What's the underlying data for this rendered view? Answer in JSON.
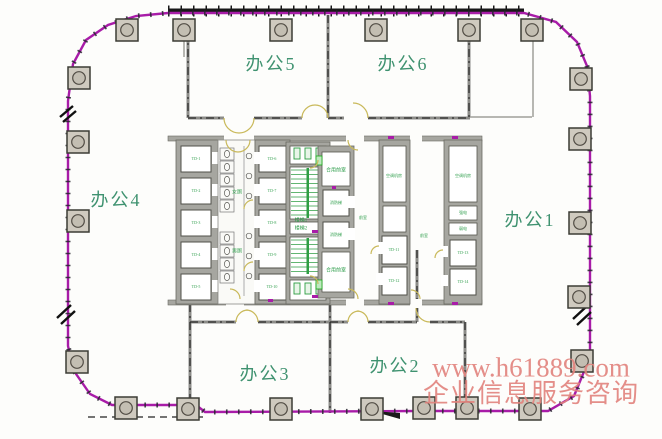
{
  "offices": [
    {
      "label": "办公1"
    },
    {
      "label": "办公2"
    },
    {
      "label": "办公3"
    },
    {
      "label": "办公4"
    },
    {
      "label": "办公5"
    },
    {
      "label": "办公6"
    }
  ],
  "core": {
    "front_room_top": "合用前室",
    "front_room_bottom": "合用前室",
    "front_room_mid": "前室",
    "front_room_right": "前室",
    "stair_1": "楼梯1",
    "stair_2": "楼梯2",
    "wc_women": "女厕",
    "wc_men": "男厕",
    "machine_room_1": "空调机房",
    "machine_room_2": "空调机房",
    "strong_power": "强电",
    "weak_power": "弱电",
    "fire_elevator_1": "消防梯",
    "fire_elevator_2": "消防梯",
    "elevators": [
      "TD-1",
      "TD-2",
      "TD-3",
      "TD-4",
      "TD-5",
      "TD-6",
      "TD-7",
      "TD-8",
      "TD-9",
      "TD-10",
      "TD-11",
      "TD-12",
      "TD-13",
      "TD-14"
    ]
  },
  "watermark": {
    "line1": "www.h61889.com",
    "line2": "企业信息服务咨询"
  },
  "colors": {
    "outline_magenta": "#a81ca8",
    "label_green": "#3f9270",
    "small_green": "#2f9e4c",
    "watermark_red": "#e2837d",
    "wall_gray": "#8c8c88",
    "stair_green": "#2f9e44"
  }
}
